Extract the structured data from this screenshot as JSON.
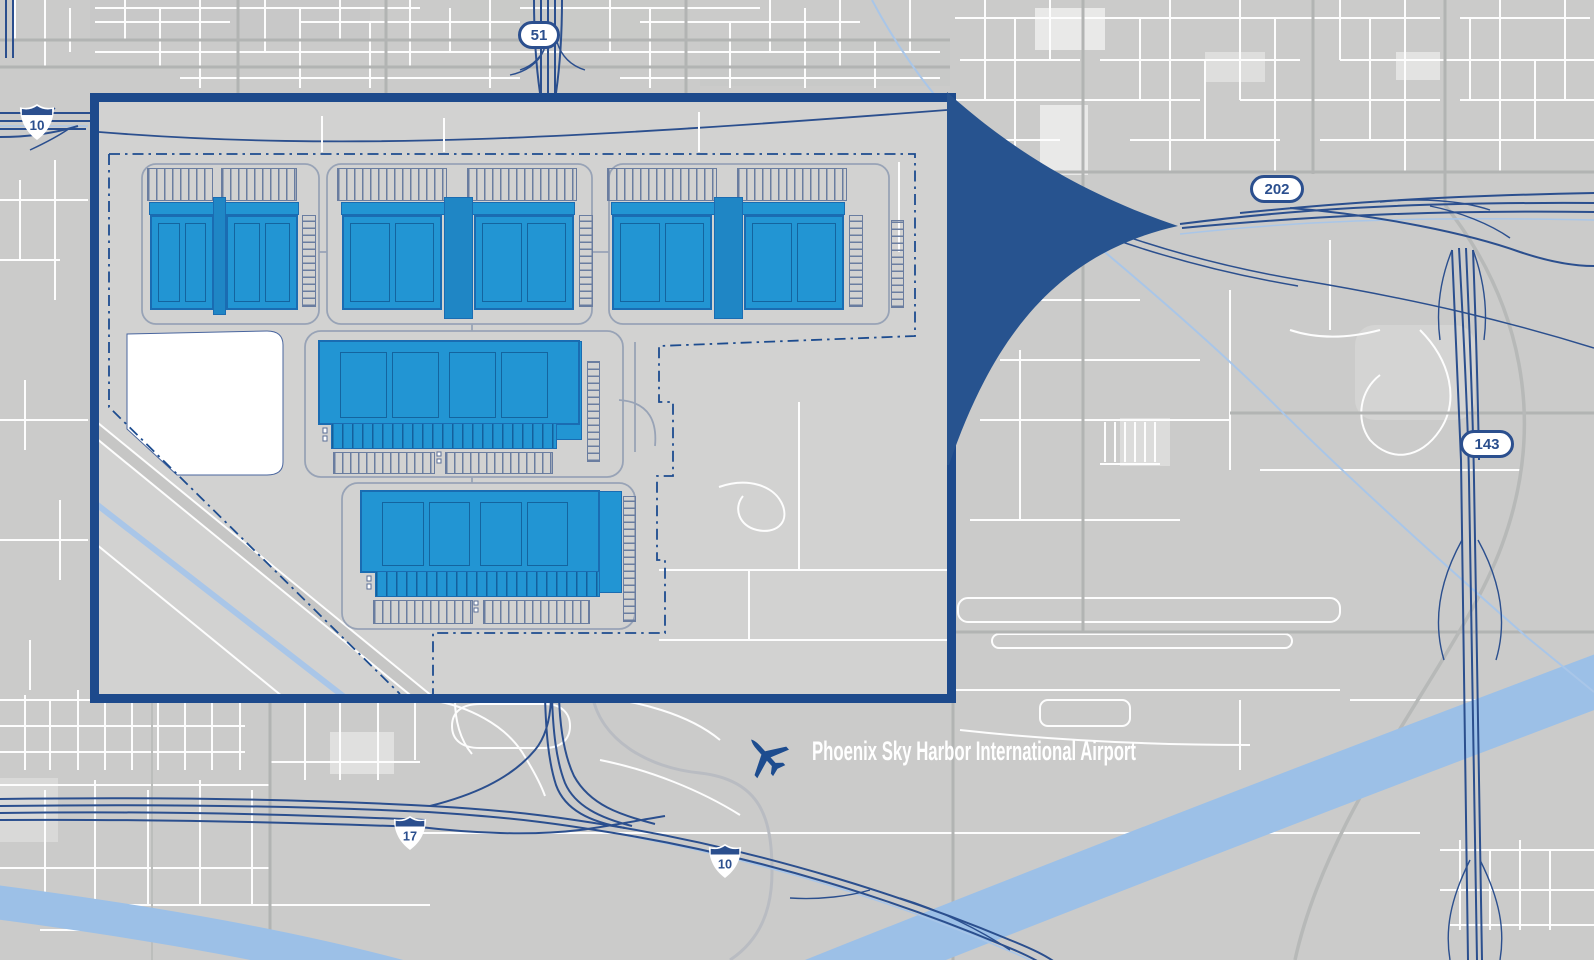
{
  "title": "Phoenix Sky Harbor area site location map",
  "map": {
    "colors": {
      "background": "#cbcbca",
      "streets": "#fdfdfd",
      "arterials": "#b2b4b3",
      "freeways": "#2b4f8e",
      "river": "#9cc0e7",
      "canal": "#a9c6e8",
      "callout": "#27538f"
    },
    "shields": [
      {
        "route": "51",
        "type": "state-route"
      },
      {
        "route": "10",
        "type": "interstate"
      },
      {
        "route": "202",
        "type": "state-route"
      },
      {
        "route": "143",
        "type": "state-route"
      },
      {
        "route": "17",
        "type": "interstate"
      },
      {
        "route": "10",
        "type": "interstate"
      }
    ],
    "airport": {
      "name": "Phoenix Sky Harbor International Airport",
      "icon": "airplane-icon",
      "text_color": "#ffffff",
      "icon_color": "#1d4c8f"
    }
  },
  "inset": {
    "type": "site-plan-callout",
    "border_color": "#1d4a8c",
    "background": "#d2d2d1",
    "building_fill": "#2295d3",
    "building_outline": "#1a6cb2",
    "boundary_line_color": "#1d4c8f",
    "boundary_line_style": "dash-dot",
    "building_groups": [
      {
        "id": "north-cluster-1",
        "buildings": 2
      },
      {
        "id": "north-cluster-2",
        "buildings": 2
      },
      {
        "id": "north-cluster-3",
        "buildings": 2
      },
      {
        "id": "central-building",
        "buildings": 1
      },
      {
        "id": "south-building",
        "buildings": 1
      }
    ]
  }
}
